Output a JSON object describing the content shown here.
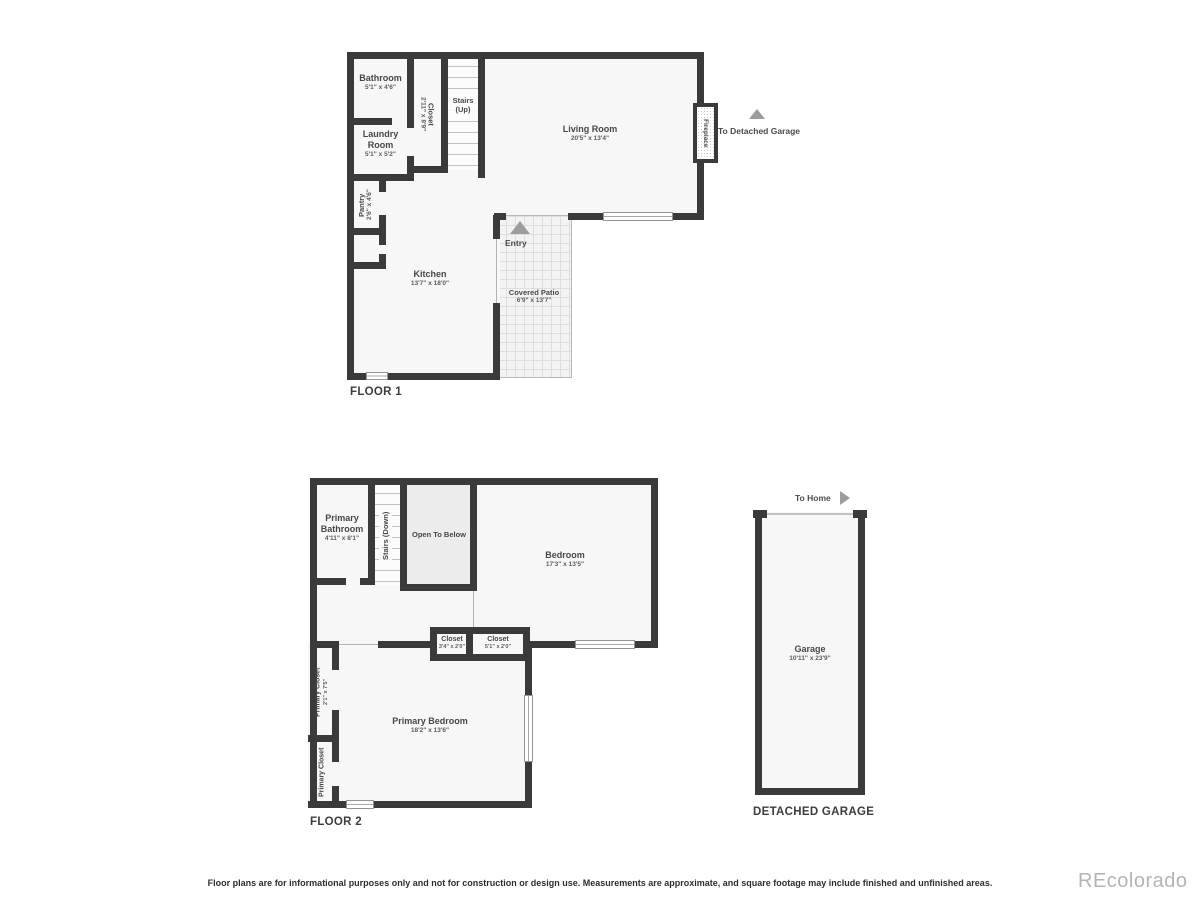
{
  "colors": {
    "wall": "#3a3a3a",
    "room_fill": "#f7f7f7",
    "open_to_below_fill": "#ececec",
    "arrow": "#9c9c9c",
    "label_text": "#474747",
    "watermark": "#b4b4b4"
  },
  "floor1": {
    "title": "FLOOR 1",
    "rooms": {
      "bathroom": {
        "name": "Bathroom",
        "dims": "5'1\" x 4'6\""
      },
      "closet": {
        "name": "Closet",
        "dims": "2'11\" x 8'9\""
      },
      "stairs_up": {
        "name": "Stairs (Up)"
      },
      "laundry": {
        "name": "Laundry Room",
        "dims": "5'1\" x 5'2\""
      },
      "living_room": {
        "name": "Living Room",
        "dims": "20'5\" x 13'4\""
      },
      "kitchen": {
        "name": "Kitchen",
        "dims": "13'7\" x 18'0\""
      },
      "pantry": {
        "name": "Pantry",
        "dims": "2'6\" x 4'6\""
      },
      "covered_patio": {
        "name": "Covered Patio",
        "dims": "6'9\" x 13'7\""
      },
      "entry": {
        "name": "Entry"
      },
      "fireplace": {
        "name": "Fireplace"
      }
    },
    "annotations": {
      "to_detached_garage": "To Detached Garage"
    }
  },
  "floor2": {
    "title": "FLOOR 2",
    "rooms": {
      "primary_bathroom": {
        "name": "Primary Bathroom",
        "dims": "4'11\" x 8'1\""
      },
      "stairs_down": {
        "name": "Stairs (Down)"
      },
      "open_to_below": {
        "name": "Open To Below"
      },
      "bedroom": {
        "name": "Bedroom",
        "dims": "17'3\" x 13'5\""
      },
      "closet_a": {
        "name": "Closet",
        "dims": "3'4\" x 2'0\""
      },
      "closet_b": {
        "name": "Closet",
        "dims": "5'1\" x 2'0\""
      },
      "primary_closet_a": {
        "name": "Primary Closet",
        "dims": "2'1\" x 7'5\""
      },
      "primary_closet_b": {
        "name": "Primary Closet"
      },
      "primary_bedroom": {
        "name": "Primary Bedroom",
        "dims": "18'2\" x 13'6\""
      }
    }
  },
  "garage": {
    "title": "DETACHED GARAGE",
    "rooms": {
      "garage": {
        "name": "Garage",
        "dims": "10'11\" x 23'9\""
      }
    },
    "annotations": {
      "to_home": "To Home"
    }
  },
  "footer": {
    "disclaimer": "Floor plans are for informational purposes only and not for construction or design use. Measurements are approximate, and square footage may include finished and unfinished areas.",
    "watermark": "REcolorado"
  }
}
